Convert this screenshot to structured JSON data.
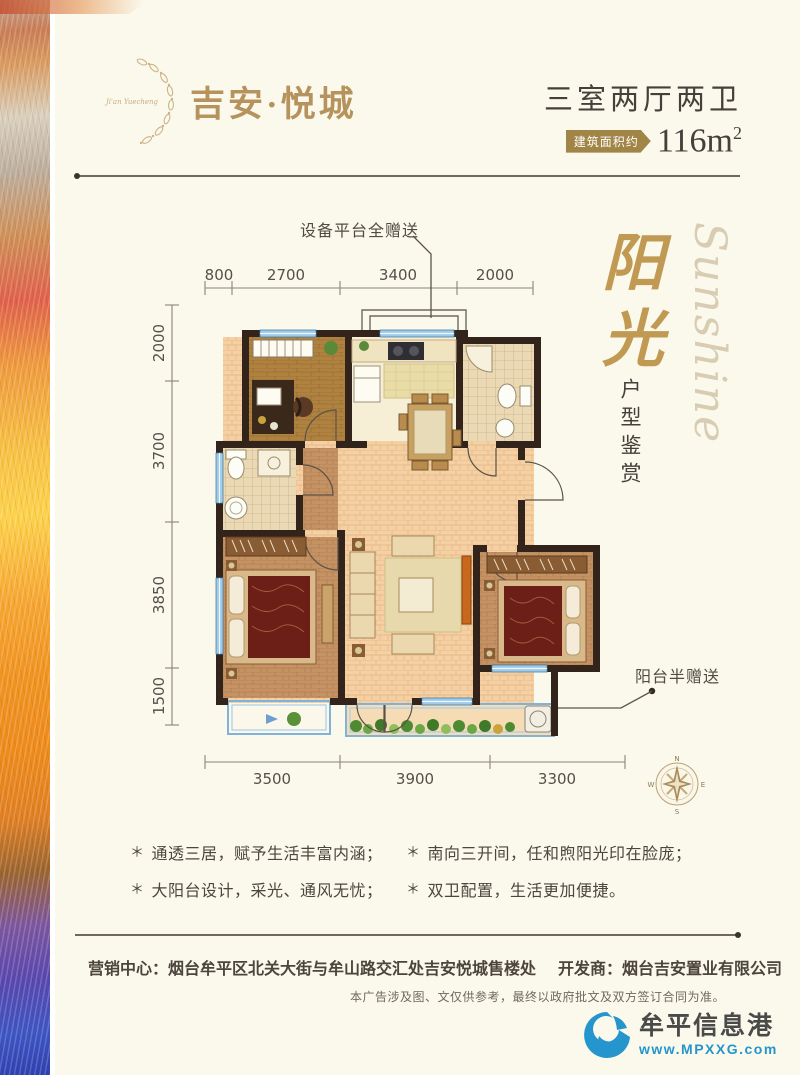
{
  "colors": {
    "gold": "#b6935c",
    "text_dark": "#46403a",
    "wall": "#32241a",
    "window_blue": "#9ecbe8",
    "logo_blue": "#2596cd"
  },
  "header": {
    "brand_script": "Ji'an Yuecheng",
    "brand_name": "吉安·悦城",
    "unit_type": "三室两厅两卫",
    "area_tag": "建筑面积约",
    "area_value": "116m",
    "area_sup": "2"
  },
  "floorplan": {
    "callout_platform": "设备平台全赠送",
    "callout_balcony": "阳台半赠送",
    "dims_top": [
      "800",
      "2700",
      "3400",
      "2000"
    ],
    "dims_left": [
      "2000",
      "3700",
      "3850",
      "1500"
    ],
    "dims_bottom": [
      "3500",
      "3900",
      "3300"
    ],
    "compass": {
      "n": "N",
      "e": "E",
      "s": "S",
      "w": "W"
    }
  },
  "side_titles": {
    "title_cn": "阳光",
    "title_en": "Sunshine",
    "subtitle": "户型鉴赏"
  },
  "features": {
    "bullet": "＊",
    "items": [
      "通透三居，赋予生活丰富内涵；",
      "大阳台设计，采光、通风无忧；",
      "南向三开间，任和煦阳光印在脸庞；",
      "双卫配置，生活更加便捷。"
    ]
  },
  "footer": {
    "sales": "营销中心：烟台牟平区北关大街与牟山路交汇处吉安悦城售楼处",
    "developer": "开发商：烟台吉安置业有限公司",
    "disclaimer": "本广告涉及图、文仅供参考，最终以政府批文及双方签订合同为准。",
    "site_name": "牟平信息港",
    "site_url": "www.MPXXG.com"
  }
}
